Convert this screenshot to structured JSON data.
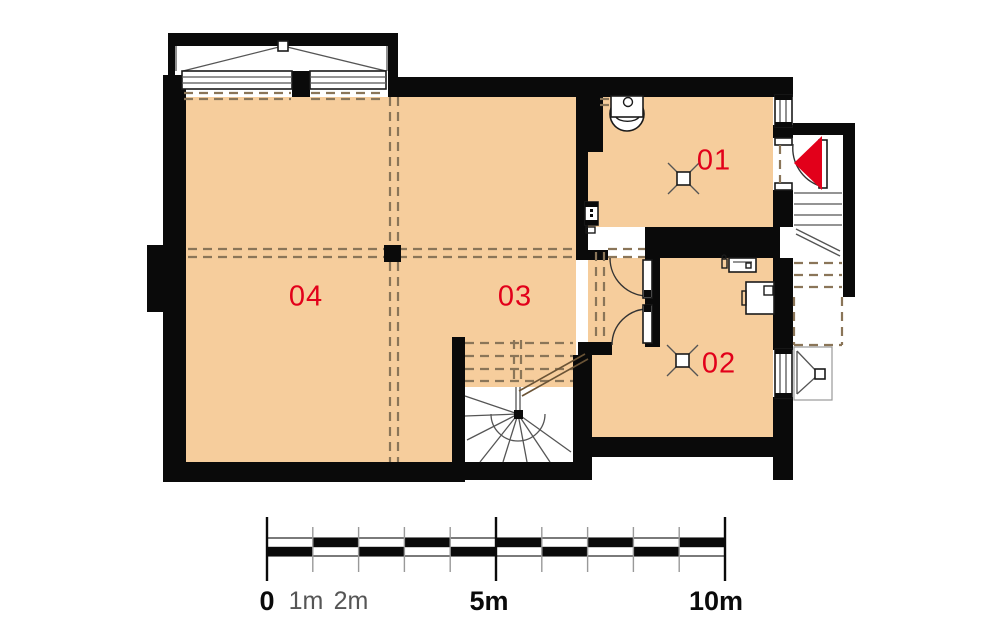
{
  "title": "basement floor plan",
  "rooms": {
    "r01": {
      "label": "01"
    },
    "r02": {
      "label": "02"
    },
    "r03": {
      "label": "03"
    },
    "r04": {
      "label": "04"
    }
  },
  "scale": {
    "zero": "0",
    "one": "1m",
    "two": "2m",
    "five": "5m",
    "ten": "10m",
    "segments": 10
  },
  "colors": {
    "floor": "#F6CD9C",
    "wall": "#0A0A0A",
    "label_red": "#E2001A",
    "dash": "#8A7558",
    "scale_gray": "#8C8C8C"
  }
}
